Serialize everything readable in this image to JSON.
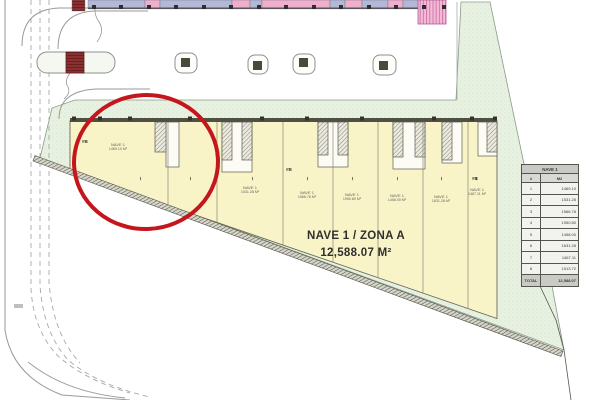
{
  "drawing_title": "Planta de conjunto - Nave industrial",
  "main_label": {
    "name": "NAVE 1 / ZONA A",
    "area": "12,588.07 M²"
  },
  "building": {
    "units": [
      {
        "name": "NAVE 1",
        "area": "1469.10 M²"
      },
      {
        "name": "NAVE 1",
        "area": "1531.28 M²"
      },
      {
        "name": "NAVE 1",
        "area": "1566.78 M²"
      },
      {
        "name": "NAVE 1",
        "area": "1950.80 M²"
      },
      {
        "name": "NAVE 1",
        "area": "1458.00 M²"
      },
      {
        "name": "NAVE 1",
        "area": "1631.28 M²"
      },
      {
        "name": "NAVE 1",
        "area": "1467.11 M²"
      }
    ],
    "door_markers": [
      "#B",
      "#B",
      "#B"
    ]
  },
  "area_table": {
    "title": "NAVE 1",
    "columns": [
      "#",
      "M2"
    ],
    "rows": [
      [
        "1",
        "1469.10"
      ],
      [
        "2",
        "1531.28"
      ],
      [
        "3",
        "1566.78"
      ],
      [
        "4",
        "1950.80"
      ],
      [
        "5",
        "1458.00"
      ],
      [
        "6",
        "1631.28"
      ],
      [
        "7",
        "1467.11"
      ],
      [
        "8",
        "1513.72"
      ]
    ],
    "total_label": "TOTAL",
    "total_value": "12,588.07"
  },
  "palette": {
    "building_fill": "#f8f4c8",
    "parcel_fill": "#e9f2e2",
    "annotation_red": "#c4161c",
    "strip_lavender": "#b2b8d6",
    "strip_pink": "#f0aecd"
  }
}
